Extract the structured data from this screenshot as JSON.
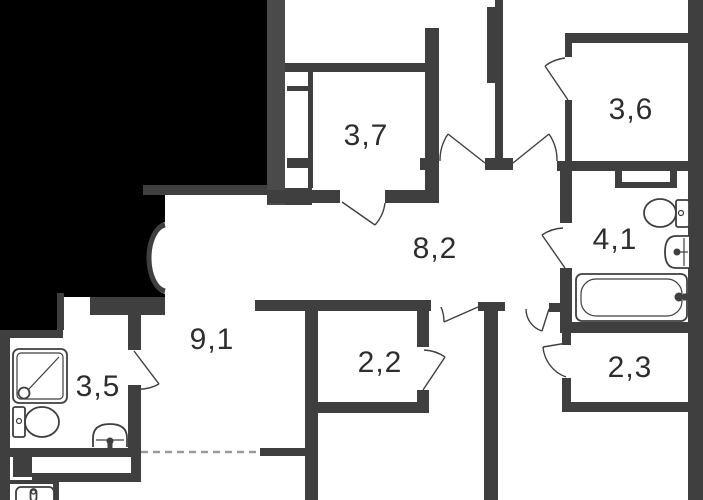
{
  "title": "apartment-floor-plan",
  "colors": {
    "wall": "#3f3f3f",
    "wall_light": "#4a4a4a",
    "mask": "#000000",
    "label": "#2e2e2e",
    "dash": "#9a9a9a",
    "bg": "#ffffff"
  },
  "rooms": [
    {
      "key": "room-3-7",
      "label": "3,7"
    },
    {
      "key": "room-3-6",
      "label": "3,6"
    },
    {
      "key": "hall-8-2",
      "label": "8,2"
    },
    {
      "key": "bathroom-4-1",
      "label": "4,1"
    },
    {
      "key": "corridor-9-1",
      "label": "9,1"
    },
    {
      "key": "room-2-2",
      "label": "2,2"
    },
    {
      "key": "room-2-3",
      "label": "2,3"
    },
    {
      "key": "shower-room-3-5",
      "label": "3,5"
    }
  ],
  "fixtures": [
    "shower-cabin",
    "toilet",
    "washbasin",
    "toilet",
    "washbasin",
    "bathtub",
    "washbasin"
  ]
}
